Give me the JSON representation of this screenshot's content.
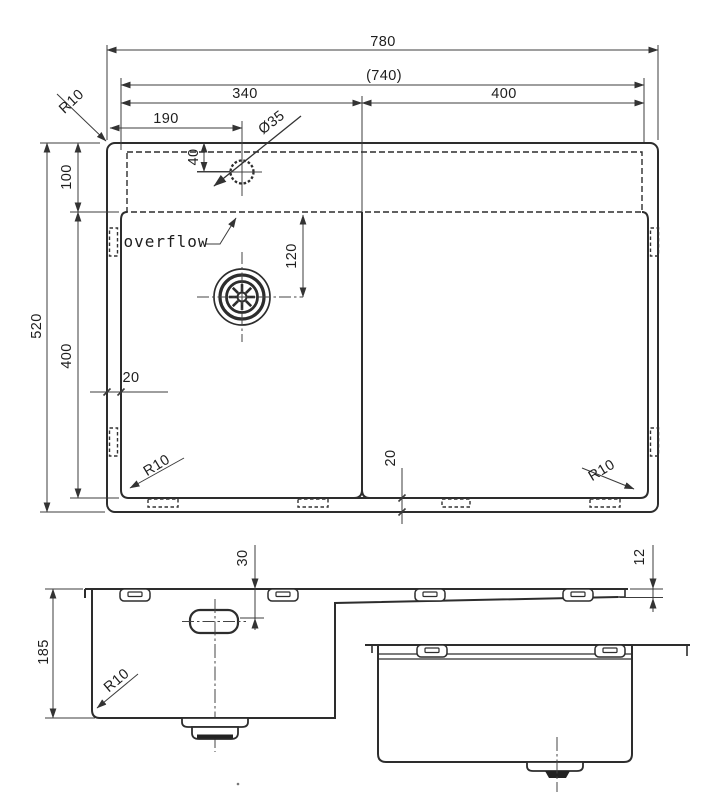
{
  "top_view": {
    "dims": {
      "overall_width": "780",
      "rim_opening_width": "(740)",
      "left_bowl_width": "340",
      "right_bowl_width": "400",
      "faucet_offset_x": "190",
      "faucet_hole_diameter": "Ø35",
      "faucet_offset_y": "40",
      "ledge_depth": "100",
      "overall_depth": "520",
      "bowl_depth": "400",
      "drain_offset_y": "120",
      "side_gap": "20",
      "bottom_gap": "20"
    },
    "radius_labels": {
      "top_left": "R10",
      "bottom_left": "R10",
      "bottom_right": "R10"
    },
    "annotations": {
      "overflow": "overflow"
    }
  },
  "front_view": {
    "dims": {
      "bowl_depth": "185",
      "overflow_drop": "30",
      "drainboard_thickness": "12"
    },
    "radius_labels": {
      "bottom_left": "R10"
    }
  }
}
